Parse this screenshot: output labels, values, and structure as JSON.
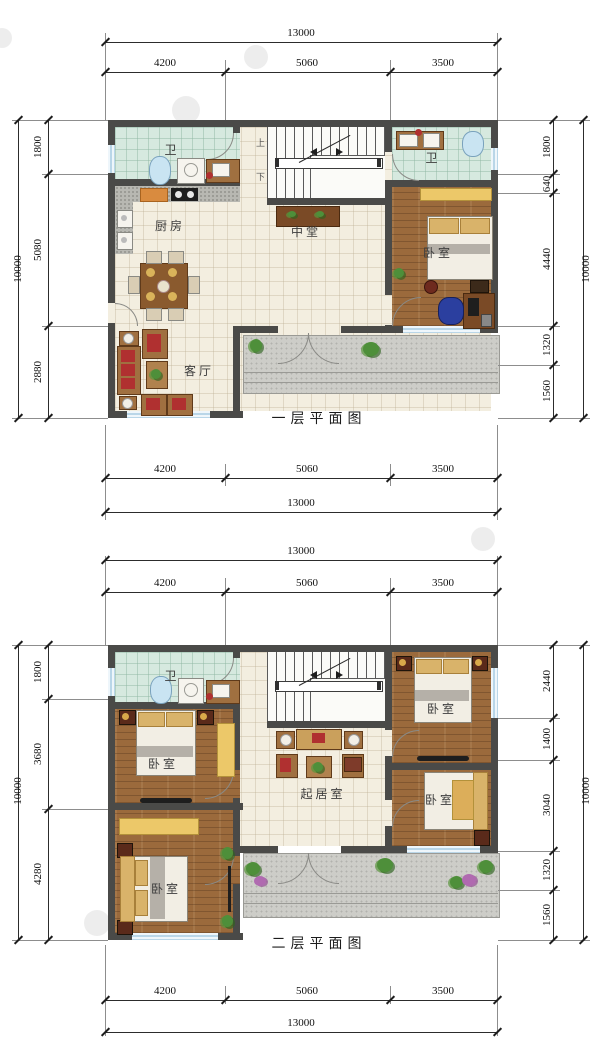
{
  "drawing": {
    "floor1": {
      "caption": "一层平面图",
      "labels": {
        "bath_left": "卫",
        "bath_right": "卫",
        "kitchen": "厨房",
        "hall": "中堂",
        "living": "客厅",
        "bedroom": "卧室",
        "stair_up": "上",
        "stair_down": "下"
      },
      "dims": {
        "top_total": "13000",
        "top_segments": [
          "4200",
          "5060",
          "3500"
        ],
        "bottom_total": "13000",
        "bottom_segments": [
          "4200",
          "5060",
          "3500"
        ],
        "left_total": "10000",
        "left_segments": [
          "1800",
          "5080",
          "2880"
        ],
        "right_total": "10000",
        "right_segments": [
          "1800",
          "640",
          "4440",
          "1320",
          "1560"
        ]
      }
    },
    "floor2": {
      "caption": "二层平面图",
      "labels": {
        "bath": "卫",
        "bedroom_nw": "卧室",
        "bedroom_sw": "卧室",
        "bedroom_ne": "卧室",
        "bedroom_se": "卧室",
        "living": "起居室"
      },
      "dims": {
        "top_total": "13000",
        "top_segments": [
          "4200",
          "5060",
          "3500"
        ],
        "bottom_total": "13000",
        "bottom_segments": [
          "4200",
          "5060",
          "3500"
        ],
        "left_total": "10000",
        "left_segments": [
          "1800",
          "3680",
          "4280"
        ],
        "right_total": "10000",
        "right_segments": [
          "2440",
          "1400",
          "3040",
          "1320",
          "1560"
        ]
      }
    },
    "colors": {
      "wall": "#4a4a48",
      "tile_cream": "#f3eee0",
      "tile_green": "#d6e9df",
      "wood": "#9b6a3c",
      "porch_gray": "#cdcdc8",
      "closet_yellow": "#ecc869",
      "window_blue": "#cfe3f0"
    }
  }
}
